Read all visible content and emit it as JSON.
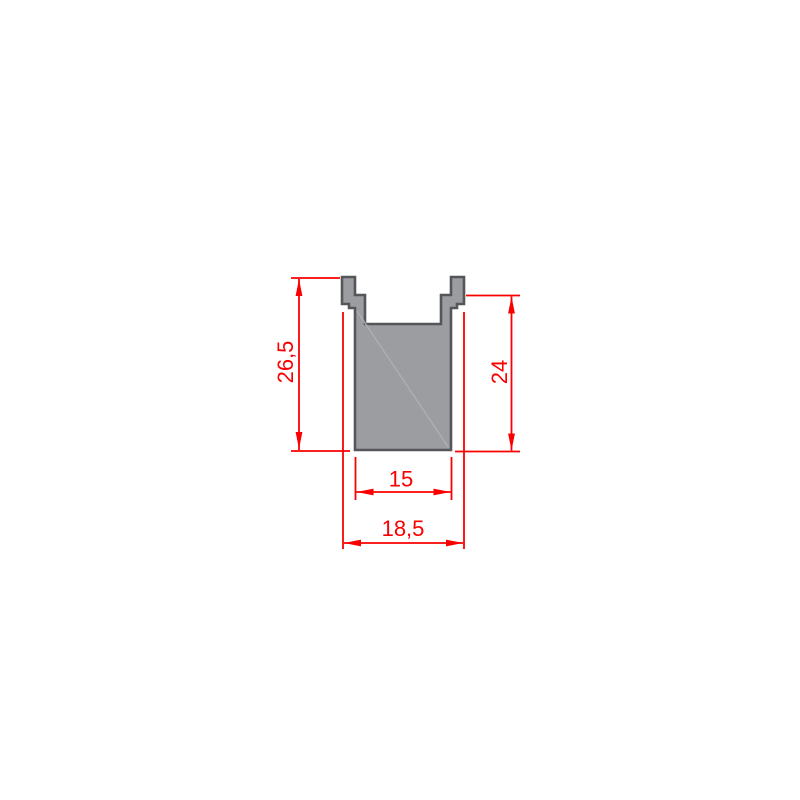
{
  "drawing": {
    "title": "channel-profile-cross-section",
    "type": "cad-dimension-drawing",
    "background_color": "#ffffff",
    "profile": {
      "fill_color": "#9b9da0",
      "outline_color": "#54565a",
      "description": "U-channel rail cross-section with two top lugs and inner groove"
    },
    "dimension_color": "#fa0000",
    "dimensions": {
      "height_overall": {
        "label": "26,5",
        "value": 26.5,
        "orientation": "vertical",
        "side": "left"
      },
      "height_body": {
        "label": "24",
        "value": 24,
        "orientation": "vertical",
        "side": "right"
      },
      "width_inner": {
        "label": "15",
        "value": 15,
        "orientation": "horizontal",
        "side": "bottom-inner"
      },
      "width_overall": {
        "label": "18,5",
        "value": 18.5,
        "orientation": "horizontal",
        "side": "bottom-outer"
      }
    }
  }
}
